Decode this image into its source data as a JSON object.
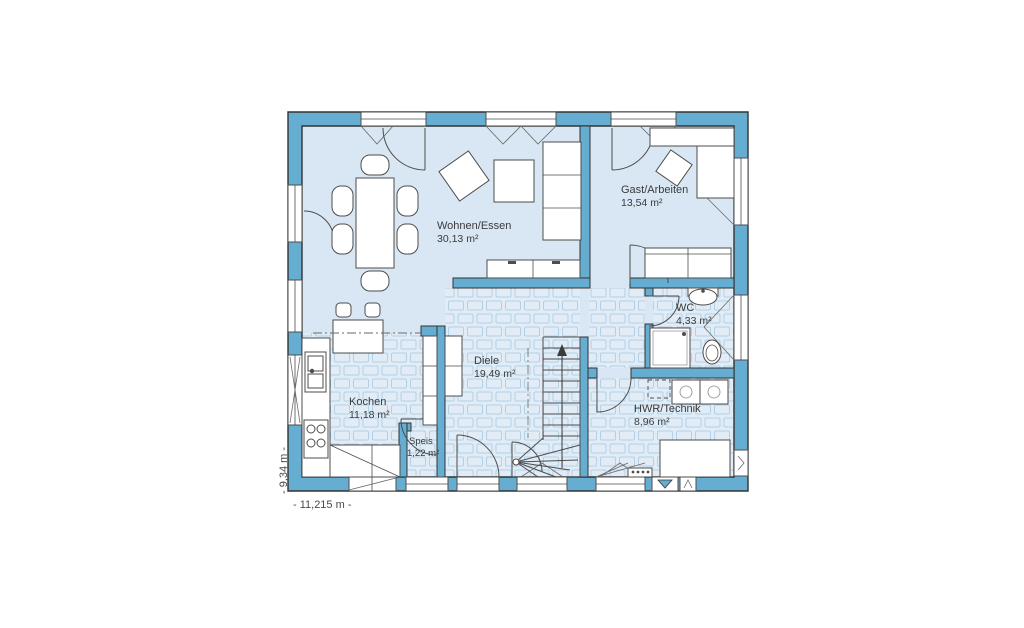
{
  "floor_plan": {
    "title": "Erdgeschoss Grundriss",
    "rooms": [
      {
        "name": "Wohnen/Essen",
        "area": "30,13 m²"
      },
      {
        "name": "Gast/Arbeiten",
        "area": "13,54 m²"
      },
      {
        "name": "WC",
        "area": "4,33 m²"
      },
      {
        "name": "Diele",
        "area": "19,49 m²"
      },
      {
        "name": "Kochen",
        "area": "11,18 m²"
      },
      {
        "name": "Speis",
        "area": "1,22 m²"
      },
      {
        "name": "HWR/Technik",
        "area": "8,96 m²"
      }
    ],
    "dimensions": {
      "total_width": "- 11,215 m -",
      "total_depth": "- 9,34 m -"
    },
    "colors": {
      "wall": "#66add2",
      "floor": "#d8e7f3",
      "tile_floor": "#e1ecf6",
      "tile_line": "#b3d0e5",
      "outline": "#333333"
    }
  }
}
